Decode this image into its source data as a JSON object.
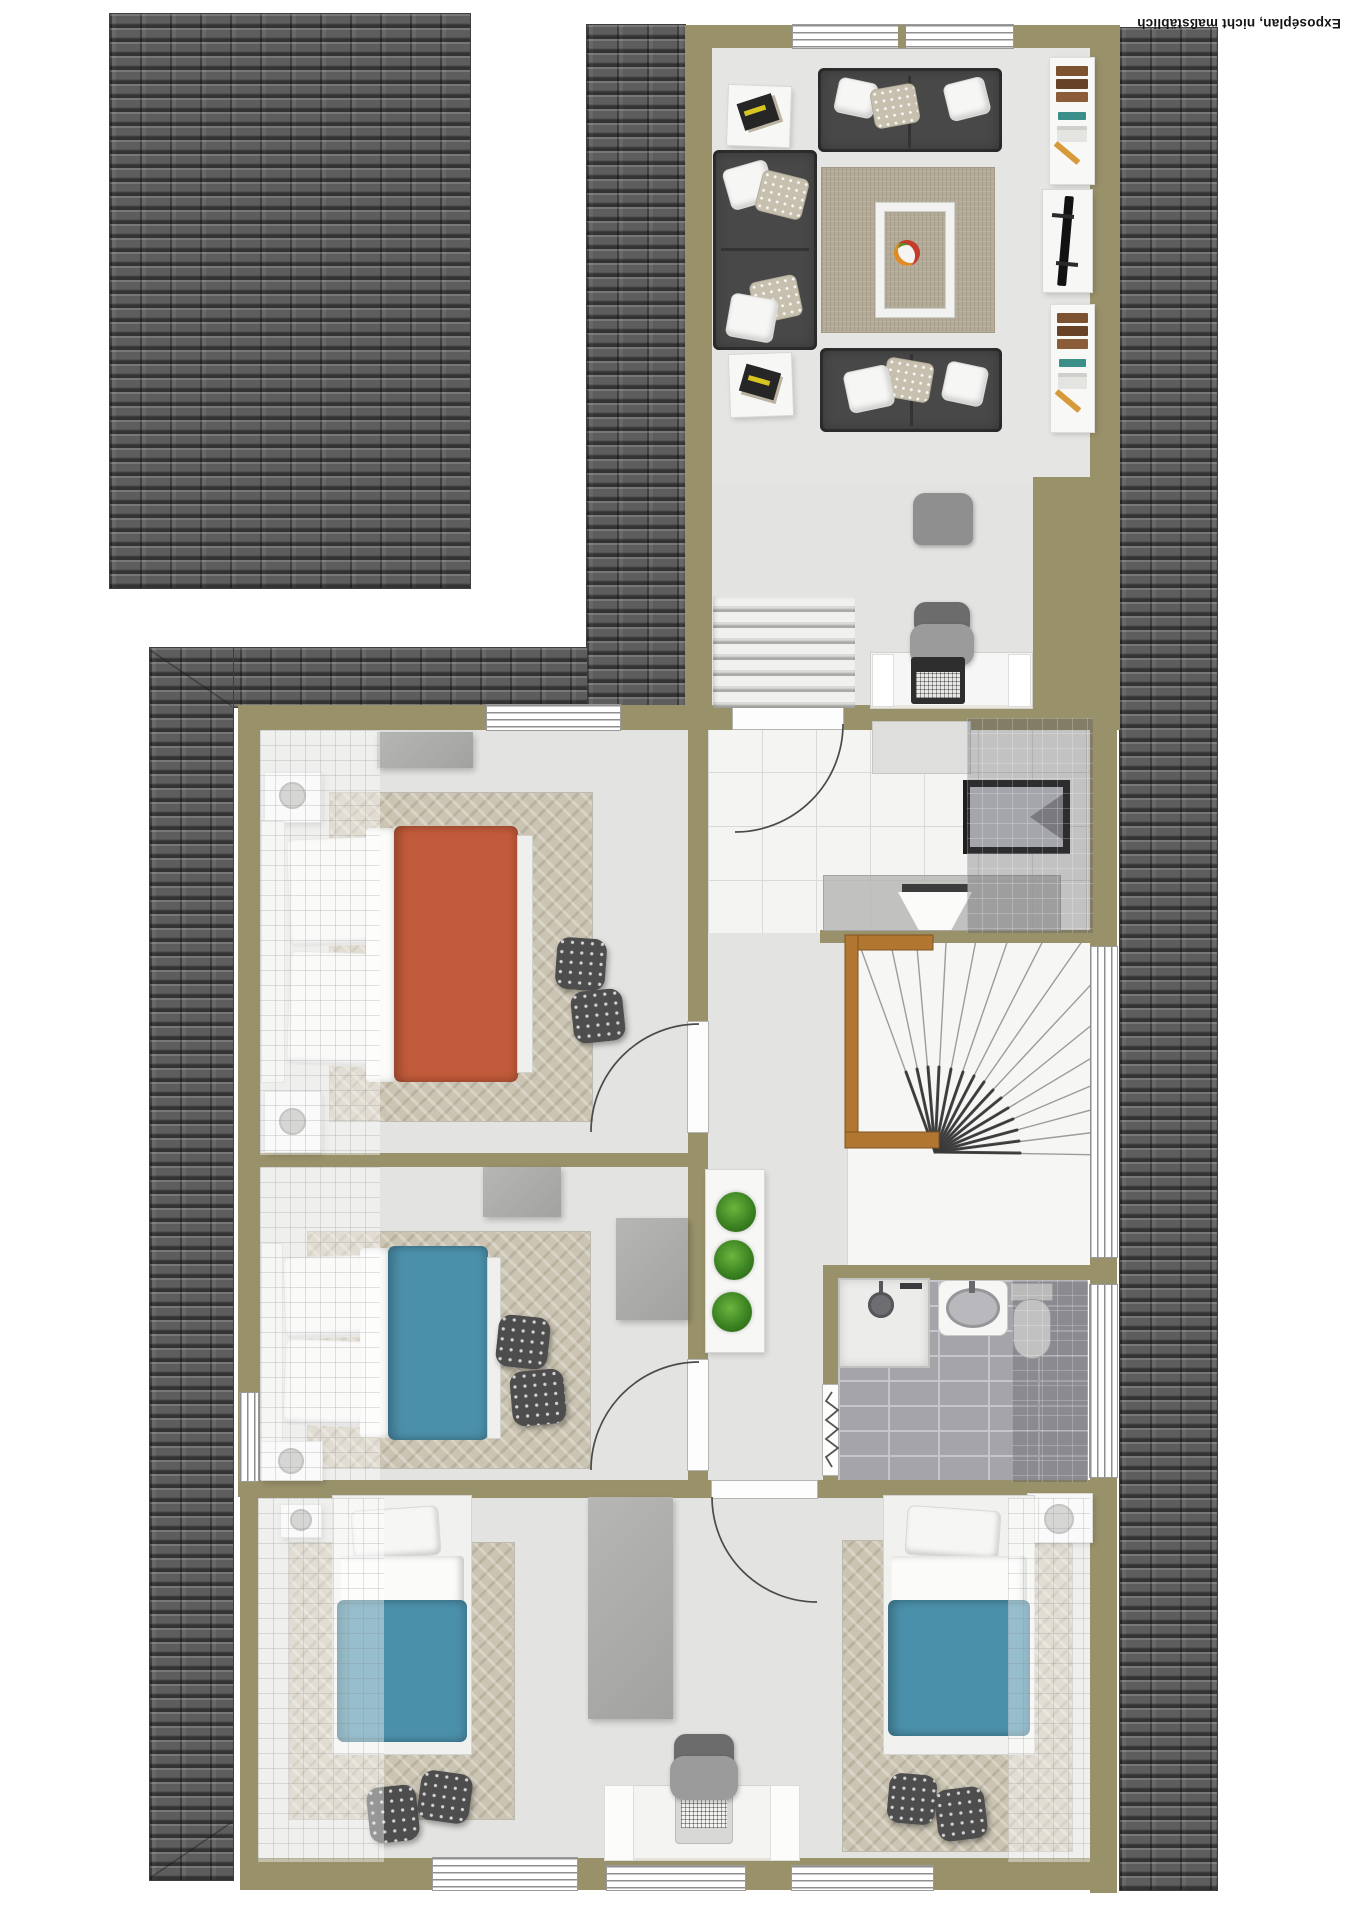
{
  "disclaimer": "Exposéplan, nicht maßstäblich",
  "plan_type": "attic floor plan, top-down 3D render",
  "palette": {
    "wall_olive": "#99916a",
    "roof_gray": "#5d5d5d",
    "floor_gray": "#e3e3e1",
    "hall_tile": "#f4f4f3",
    "bath_tile": "#a4a4a9",
    "rug_beige": "#cbc4b2",
    "sofa_gray": "#484848",
    "duvet_red": "#c25b3b",
    "duvet_blue": "#4b90aa",
    "wood_rail": "#b1762f",
    "plant_green": "#3c8422"
  },
  "rooms": [
    {
      "name": "living-room",
      "furniture": [
        "corner-sofa-group",
        "two-seat-sofa",
        "area-rug",
        "coffee-table-with-fruit-bowl",
        "side-table-magazines-1",
        "side-table-magazines-2",
        "bookshelf-1",
        "tv-sideboard",
        "bookshelf-2"
      ]
    },
    {
      "name": "landing",
      "furniture": [
        "straight-staircase",
        "desk-with-laptop",
        "office-chair",
        "lounge-chair"
      ]
    },
    {
      "name": "bedroom-red",
      "furniture": [
        "double-bed-red",
        "nightstand-top",
        "nightstand-bottom",
        "dresser",
        "chevron-rug",
        "pouf-1",
        "pouf-2"
      ]
    },
    {
      "name": "hallway",
      "furniture": [
        "tiled-entrance-floor",
        "cabinet",
        "dark-framed-panel",
        "console-with-bowl",
        "plant-shelf-three-plants"
      ]
    },
    {
      "name": "stairwell",
      "furniture": [
        "winder-staircase",
        "wooden-railing"
      ]
    },
    {
      "name": "bedroom-blue",
      "furniture": [
        "double-bed-blue",
        "nightstand",
        "wardrobe-1",
        "wardrobe-2",
        "chevron-rug",
        "pouf-1",
        "pouf-2"
      ]
    },
    {
      "name": "bathroom",
      "furniture": [
        "shower",
        "washbasin",
        "toilet",
        "radiator-zigzag"
      ]
    },
    {
      "name": "kids-room-bottom",
      "furniture": [
        "single-bed-left",
        "single-bed-right",
        "nightstand-left",
        "nightstand-right",
        "tall-wardrobe",
        "desk-with-laptop",
        "desk-chair",
        "chevron-rug-left",
        "chevron-rug-right",
        "poufs"
      ]
    }
  ],
  "window_count": 8,
  "door_count": 5
}
